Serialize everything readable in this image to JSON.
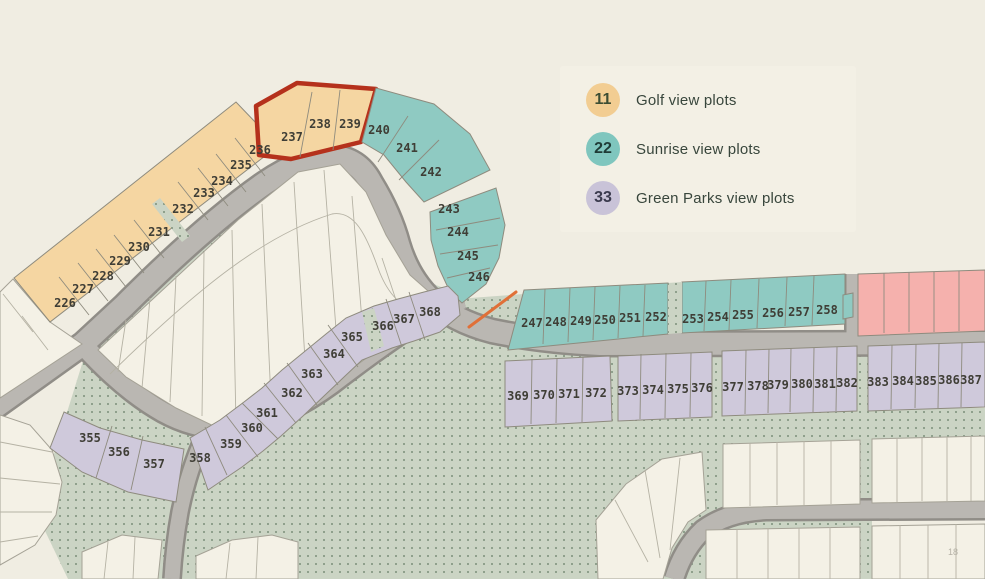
{
  "legend": {
    "items": [
      {
        "count": "11",
        "label": "Golf view plots",
        "badge_color": "#f2cd92",
        "count_color": "#3c4d33"
      },
      {
        "count": "22",
        "label": "Sunrise view plots",
        "badge_color": "#7fc6be",
        "count_color": "#1f3b36"
      },
      {
        "count": "33",
        "label": "Green Parks view plots",
        "badge_color": "#c9c3d8",
        "count_color": "#3a3a4d"
      }
    ]
  },
  "page_number": "18",
  "map": {
    "colors": {
      "background": "#f0ede2",
      "golf": "#f5d6a2",
      "sunrise": "#8fcac2",
      "parks": "#cfc9db",
      "pink": "#f5b1ad",
      "white_plot": "#f4f1e6",
      "road": "#bab7b2",
      "highlight": "#b5311c",
      "accent_line": "#e07038"
    },
    "plot_groups": [
      {
        "name": "golf-strip",
        "view": "Golf view",
        "plots": [
          {
            "n": "226",
            "x": 65,
            "y": 303
          },
          {
            "n": "227",
            "x": 83,
            "y": 289
          },
          {
            "n": "228",
            "x": 103,
            "y": 276
          },
          {
            "n": "229",
            "x": 120,
            "y": 261
          },
          {
            "n": "230",
            "x": 139,
            "y": 247
          },
          {
            "n": "231",
            "x": 159,
            "y": 232
          },
          {
            "n": "232",
            "x": 183,
            "y": 209
          },
          {
            "n": "233",
            "x": 204,
            "y": 193
          },
          {
            "n": "234",
            "x": 222,
            "y": 181
          },
          {
            "n": "235",
            "x": 241,
            "y": 165
          },
          {
            "n": "236",
            "x": 260,
            "y": 150
          }
        ]
      },
      {
        "name": "golf-highlighted",
        "view": "Golf view",
        "highlighted": true,
        "plots": [
          {
            "n": "237",
            "x": 292,
            "y": 137
          },
          {
            "n": "238",
            "x": 320,
            "y": 124
          },
          {
            "n": "239",
            "x": 350,
            "y": 124
          }
        ]
      },
      {
        "name": "sunrise-fan-upper",
        "view": "Sunrise view",
        "plots": [
          {
            "n": "240",
            "x": 379,
            "y": 130
          },
          {
            "n": "241",
            "x": 407,
            "y": 148
          },
          {
            "n": "242",
            "x": 431,
            "y": 172
          }
        ]
      },
      {
        "name": "sunrise-fan-lower",
        "view": "Sunrise view",
        "plots": [
          {
            "n": "243",
            "x": 449,
            "y": 209
          },
          {
            "n": "244",
            "x": 458,
            "y": 232
          },
          {
            "n": "245",
            "x": 468,
            "y": 256
          },
          {
            "n": "246",
            "x": 479,
            "y": 277
          }
        ]
      },
      {
        "name": "sunrise-row-west",
        "view": "Sunrise view",
        "plots": [
          {
            "n": "247",
            "x": 532,
            "y": 323
          },
          {
            "n": "248",
            "x": 556,
            "y": 322
          },
          {
            "n": "249",
            "x": 581,
            "y": 321
          },
          {
            "n": "250",
            "x": 605,
            "y": 320
          },
          {
            "n": "251",
            "x": 630,
            "y": 318
          },
          {
            "n": "252",
            "x": 656,
            "y": 317
          }
        ]
      },
      {
        "name": "sunrise-row-east",
        "view": "Sunrise view",
        "plots": [
          {
            "n": "253",
            "x": 693,
            "y": 319
          },
          {
            "n": "254",
            "x": 718,
            "y": 317
          },
          {
            "n": "255",
            "x": 743,
            "y": 315
          },
          {
            "n": "256",
            "x": 773,
            "y": 313
          },
          {
            "n": "257",
            "x": 799,
            "y": 312
          },
          {
            "n": "258",
            "x": 827,
            "y": 310
          }
        ]
      },
      {
        "name": "parks-arc-west",
        "view": "Green Parks view",
        "plots": [
          {
            "n": "355",
            "x": 90,
            "y": 438
          },
          {
            "n": "356",
            "x": 119,
            "y": 452
          },
          {
            "n": "357",
            "x": 154,
            "y": 464
          }
        ]
      },
      {
        "name": "parks-arc-east",
        "view": "Green Parks view",
        "plots": [
          {
            "n": "358",
            "x": 200,
            "y": 458
          },
          {
            "n": "359",
            "x": 231,
            "y": 444
          },
          {
            "n": "360",
            "x": 252,
            "y": 428
          },
          {
            "n": "361",
            "x": 267,
            "y": 413
          },
          {
            "n": "362",
            "x": 292,
            "y": 393
          },
          {
            "n": "363",
            "x": 312,
            "y": 374
          },
          {
            "n": "364",
            "x": 334,
            "y": 354
          },
          {
            "n": "365",
            "x": 352,
            "y": 337
          },
          {
            "n": "366",
            "x": 383,
            "y": 326
          },
          {
            "n": "367",
            "x": 404,
            "y": 319
          },
          {
            "n": "368",
            "x": 430,
            "y": 312
          }
        ]
      },
      {
        "name": "parks-row-a",
        "view": "Green Parks view",
        "plots": [
          {
            "n": "369",
            "x": 518,
            "y": 396
          },
          {
            "n": "370",
            "x": 544,
            "y": 395
          },
          {
            "n": "371",
            "x": 569,
            "y": 394
          },
          {
            "n": "372",
            "x": 596,
            "y": 393
          }
        ]
      },
      {
        "name": "parks-row-b",
        "view": "Green Parks view",
        "plots": [
          {
            "n": "373",
            "x": 628,
            "y": 391
          },
          {
            "n": "374",
            "x": 653,
            "y": 390
          },
          {
            "n": "375",
            "x": 678,
            "y": 389
          },
          {
            "n": "376",
            "x": 702,
            "y": 388
          }
        ]
      },
      {
        "name": "parks-row-c",
        "view": "Green Parks view",
        "plots": [
          {
            "n": "377",
            "x": 733,
            "y": 387
          },
          {
            "n": "378",
            "x": 758,
            "y": 386
          },
          {
            "n": "379",
            "x": 778,
            "y": 385
          },
          {
            "n": "380",
            "x": 802,
            "y": 384
          },
          {
            "n": "381",
            "x": 825,
            "y": 384
          },
          {
            "n": "382",
            "x": 847,
            "y": 383
          }
        ]
      },
      {
        "name": "parks-row-d",
        "view": "Green Parks view",
        "plots": [
          {
            "n": "383",
            "x": 878,
            "y": 382
          },
          {
            "n": "384",
            "x": 903,
            "y": 381
          },
          {
            "n": "385",
            "x": 926,
            "y": 381
          },
          {
            "n": "386",
            "x": 949,
            "y": 380
          },
          {
            "n": "387",
            "x": 971,
            "y": 380
          }
        ]
      }
    ]
  }
}
